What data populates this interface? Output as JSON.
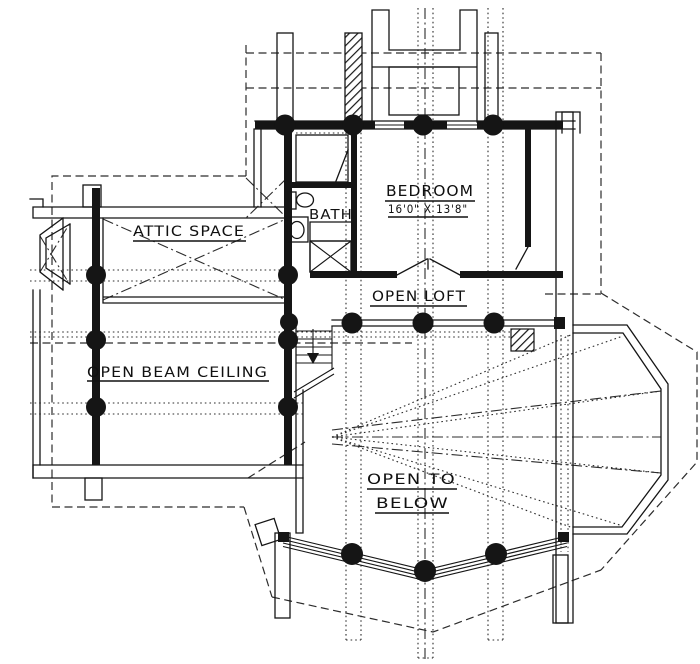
{
  "plan": {
    "rooms": {
      "attic_space": "ATTIC SPACE",
      "bedroom": "BEDROOM",
      "bedroom_dimensions": "16'0\" X 13'8\"",
      "bath": "BATH",
      "open_loft": "OPEN LOFT",
      "open_beam_ceiling": "OPEN BEAM CEILING",
      "open_to_below_line1": "OPEN TO",
      "open_to_below_line2": "BELOW"
    },
    "colors": {
      "ink": "#151515",
      "paper": "#ffffff"
    }
  }
}
